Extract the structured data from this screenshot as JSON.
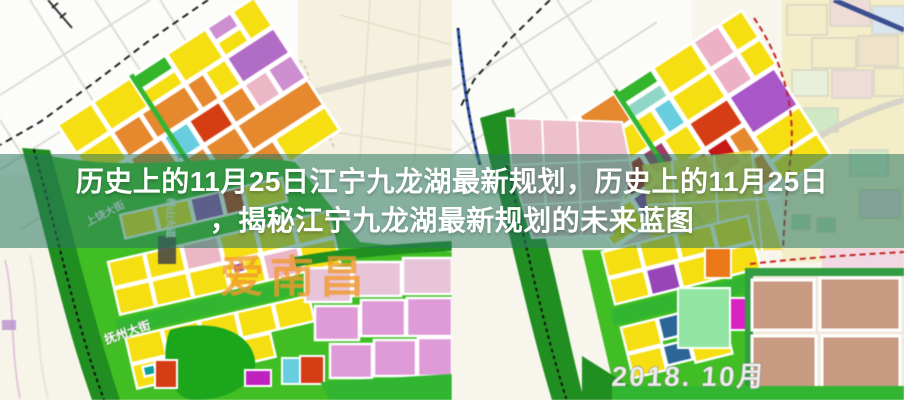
{
  "banner": {
    "overlay_color": "rgba(40,118,94,0.55)",
    "text_color": "#ffffff",
    "line1": "历史上的11月25日江宁九龙湖最新规划，历史上的11月25日",
    "line2": "，揭秘江宁九龙湖最新规划的未来蓝图"
  },
  "left_map": {
    "watermark": "爱南昌",
    "watermark_color": "#f59a2a",
    "street_label_diagonal": "抚州大街",
    "street_label_upper": "上饶大街",
    "street_label_vertical": "杨山大道"
  },
  "right_map": {
    "date_stamp": "2018. 10月",
    "date_stamp_color": "#ececec"
  },
  "palette": {
    "residential_yellow": "#f6df0a",
    "commercial_red": "#da3d12",
    "mixed_orange": "#e8872a",
    "public_purple": "#b36cc8",
    "education_cyan": "#63cfe0",
    "service_pink": "#edb6c6",
    "orchid_pink": "#e09ada",
    "green_space": "#2eb82e",
    "dark_green_corridor": "#1d8f1d",
    "magenta_special": "#e020c8",
    "tan_village": "#c99a80"
  }
}
